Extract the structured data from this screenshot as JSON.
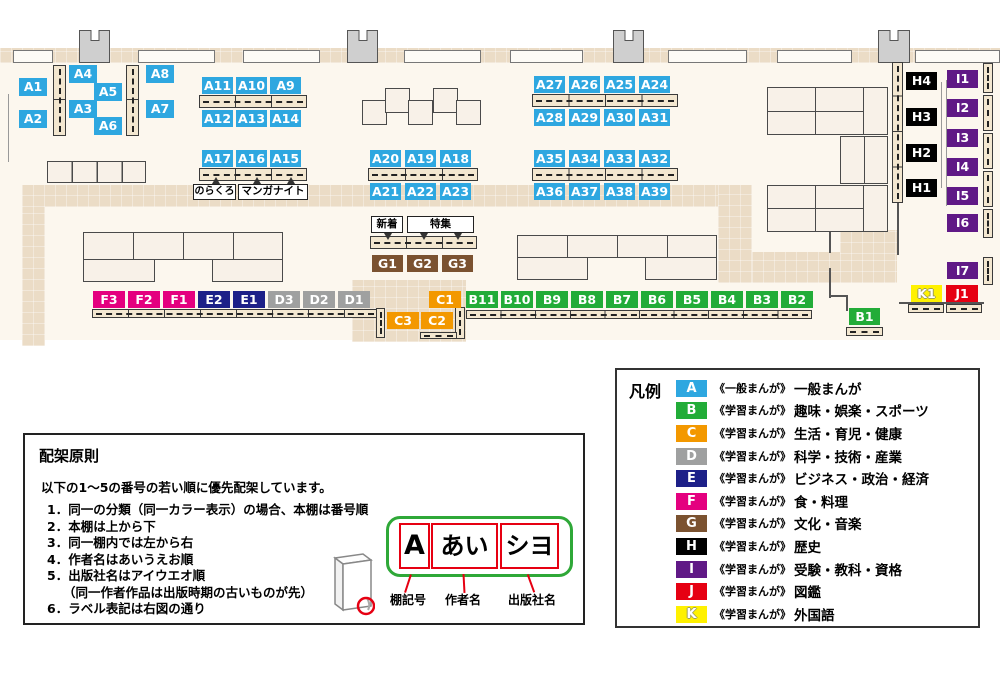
{
  "colors": {
    "A": "#2EA7E0",
    "B": "#22AC38",
    "C": "#F39800",
    "D": "#9FA0A0",
    "E": "#1D2088",
    "F": "#E4007F",
    "G": "#7B5230",
    "H": "#000000",
    "I": "#601986",
    "J": "#E60012",
    "K": "#FFF100"
  },
  "map": {
    "a": [
      "A1",
      "A2",
      "A3",
      "A4",
      "A5",
      "A6",
      "A7",
      "A8",
      "A9",
      "A10",
      "A11",
      "A12",
      "A13",
      "A14",
      "A15",
      "A16",
      "A17",
      "A18",
      "A19",
      "A20",
      "A21",
      "A22",
      "A23",
      "A24",
      "A25",
      "A26",
      "A27",
      "A28",
      "A29",
      "A30",
      "A31",
      "A32",
      "A33",
      "A34",
      "A35",
      "A36",
      "A37",
      "A38",
      "A39"
    ],
    "b": [
      "B1",
      "B2",
      "B3",
      "B4",
      "B5",
      "B6",
      "B7",
      "B8",
      "B9",
      "B10",
      "B11"
    ],
    "c": [
      "C1",
      "C2",
      "C3"
    ],
    "d": [
      "D1",
      "D2",
      "D3"
    ],
    "e": [
      "E1",
      "E2"
    ],
    "f": [
      "F1",
      "F2",
      "F3"
    ],
    "g": [
      "G1",
      "G2",
      "G3"
    ],
    "h": [
      "H1",
      "H2",
      "H3",
      "H4"
    ],
    "i": [
      "I1",
      "I2",
      "I3",
      "I4",
      "I5",
      "I6",
      "I7"
    ],
    "j": [
      "J1"
    ],
    "k": [
      "K1"
    ],
    "callouts": {
      "norakuro": "のらくろ",
      "manganight": "マンガナイト",
      "new_arrival": "新着",
      "feature": "特集"
    }
  },
  "legend": {
    "title": "凡例",
    "rows": [
      {
        "letter": "A",
        "type": "《一般まんが》",
        "category": "一般まんが"
      },
      {
        "letter": "B",
        "type": "《学習まんが》",
        "category": "趣味・娯楽・スポーツ"
      },
      {
        "letter": "C",
        "type": "《学習まんが》",
        "category": "生活・育児・健康"
      },
      {
        "letter": "D",
        "type": "《学習まんが》",
        "category": "科学・技術・産業"
      },
      {
        "letter": "E",
        "type": "《学習まんが》",
        "category": "ビジネス・政治・経済"
      },
      {
        "letter": "F",
        "type": "《学習まんが》",
        "category": "食・料理"
      },
      {
        "letter": "G",
        "type": "《学習まんが》",
        "category": "文化・音楽"
      },
      {
        "letter": "H",
        "type": "《学習まんが》",
        "category": "歴史"
      },
      {
        "letter": "I",
        "type": "《学習まんが》",
        "category": "受験・教科・資格"
      },
      {
        "letter": "J",
        "type": "《学習まんが》",
        "category": "図鑑"
      },
      {
        "letter": "K",
        "type": "《学習まんが》",
        "category": "外国語"
      }
    ]
  },
  "principles": {
    "title": "配架原則",
    "intro": "以下の1～5の番号の若い順に優先配架しています。",
    "lines": [
      "1．同一の分類（同一カラー表示）の場合、本棚は番号順",
      "2．本棚は上から下",
      "3．同一棚内では左から右",
      "4．作者名はあいうえお順",
      "5．出版社名はアイウエオ順",
      "（同一作者作品は出版時期の古いものが先）",
      "6．ラベル表記は右図の通り"
    ],
    "example": {
      "cells": [
        "A",
        "あい",
        "シヨ"
      ],
      "captions": [
        "棚記号",
        "作者名",
        "出版社名"
      ]
    }
  }
}
